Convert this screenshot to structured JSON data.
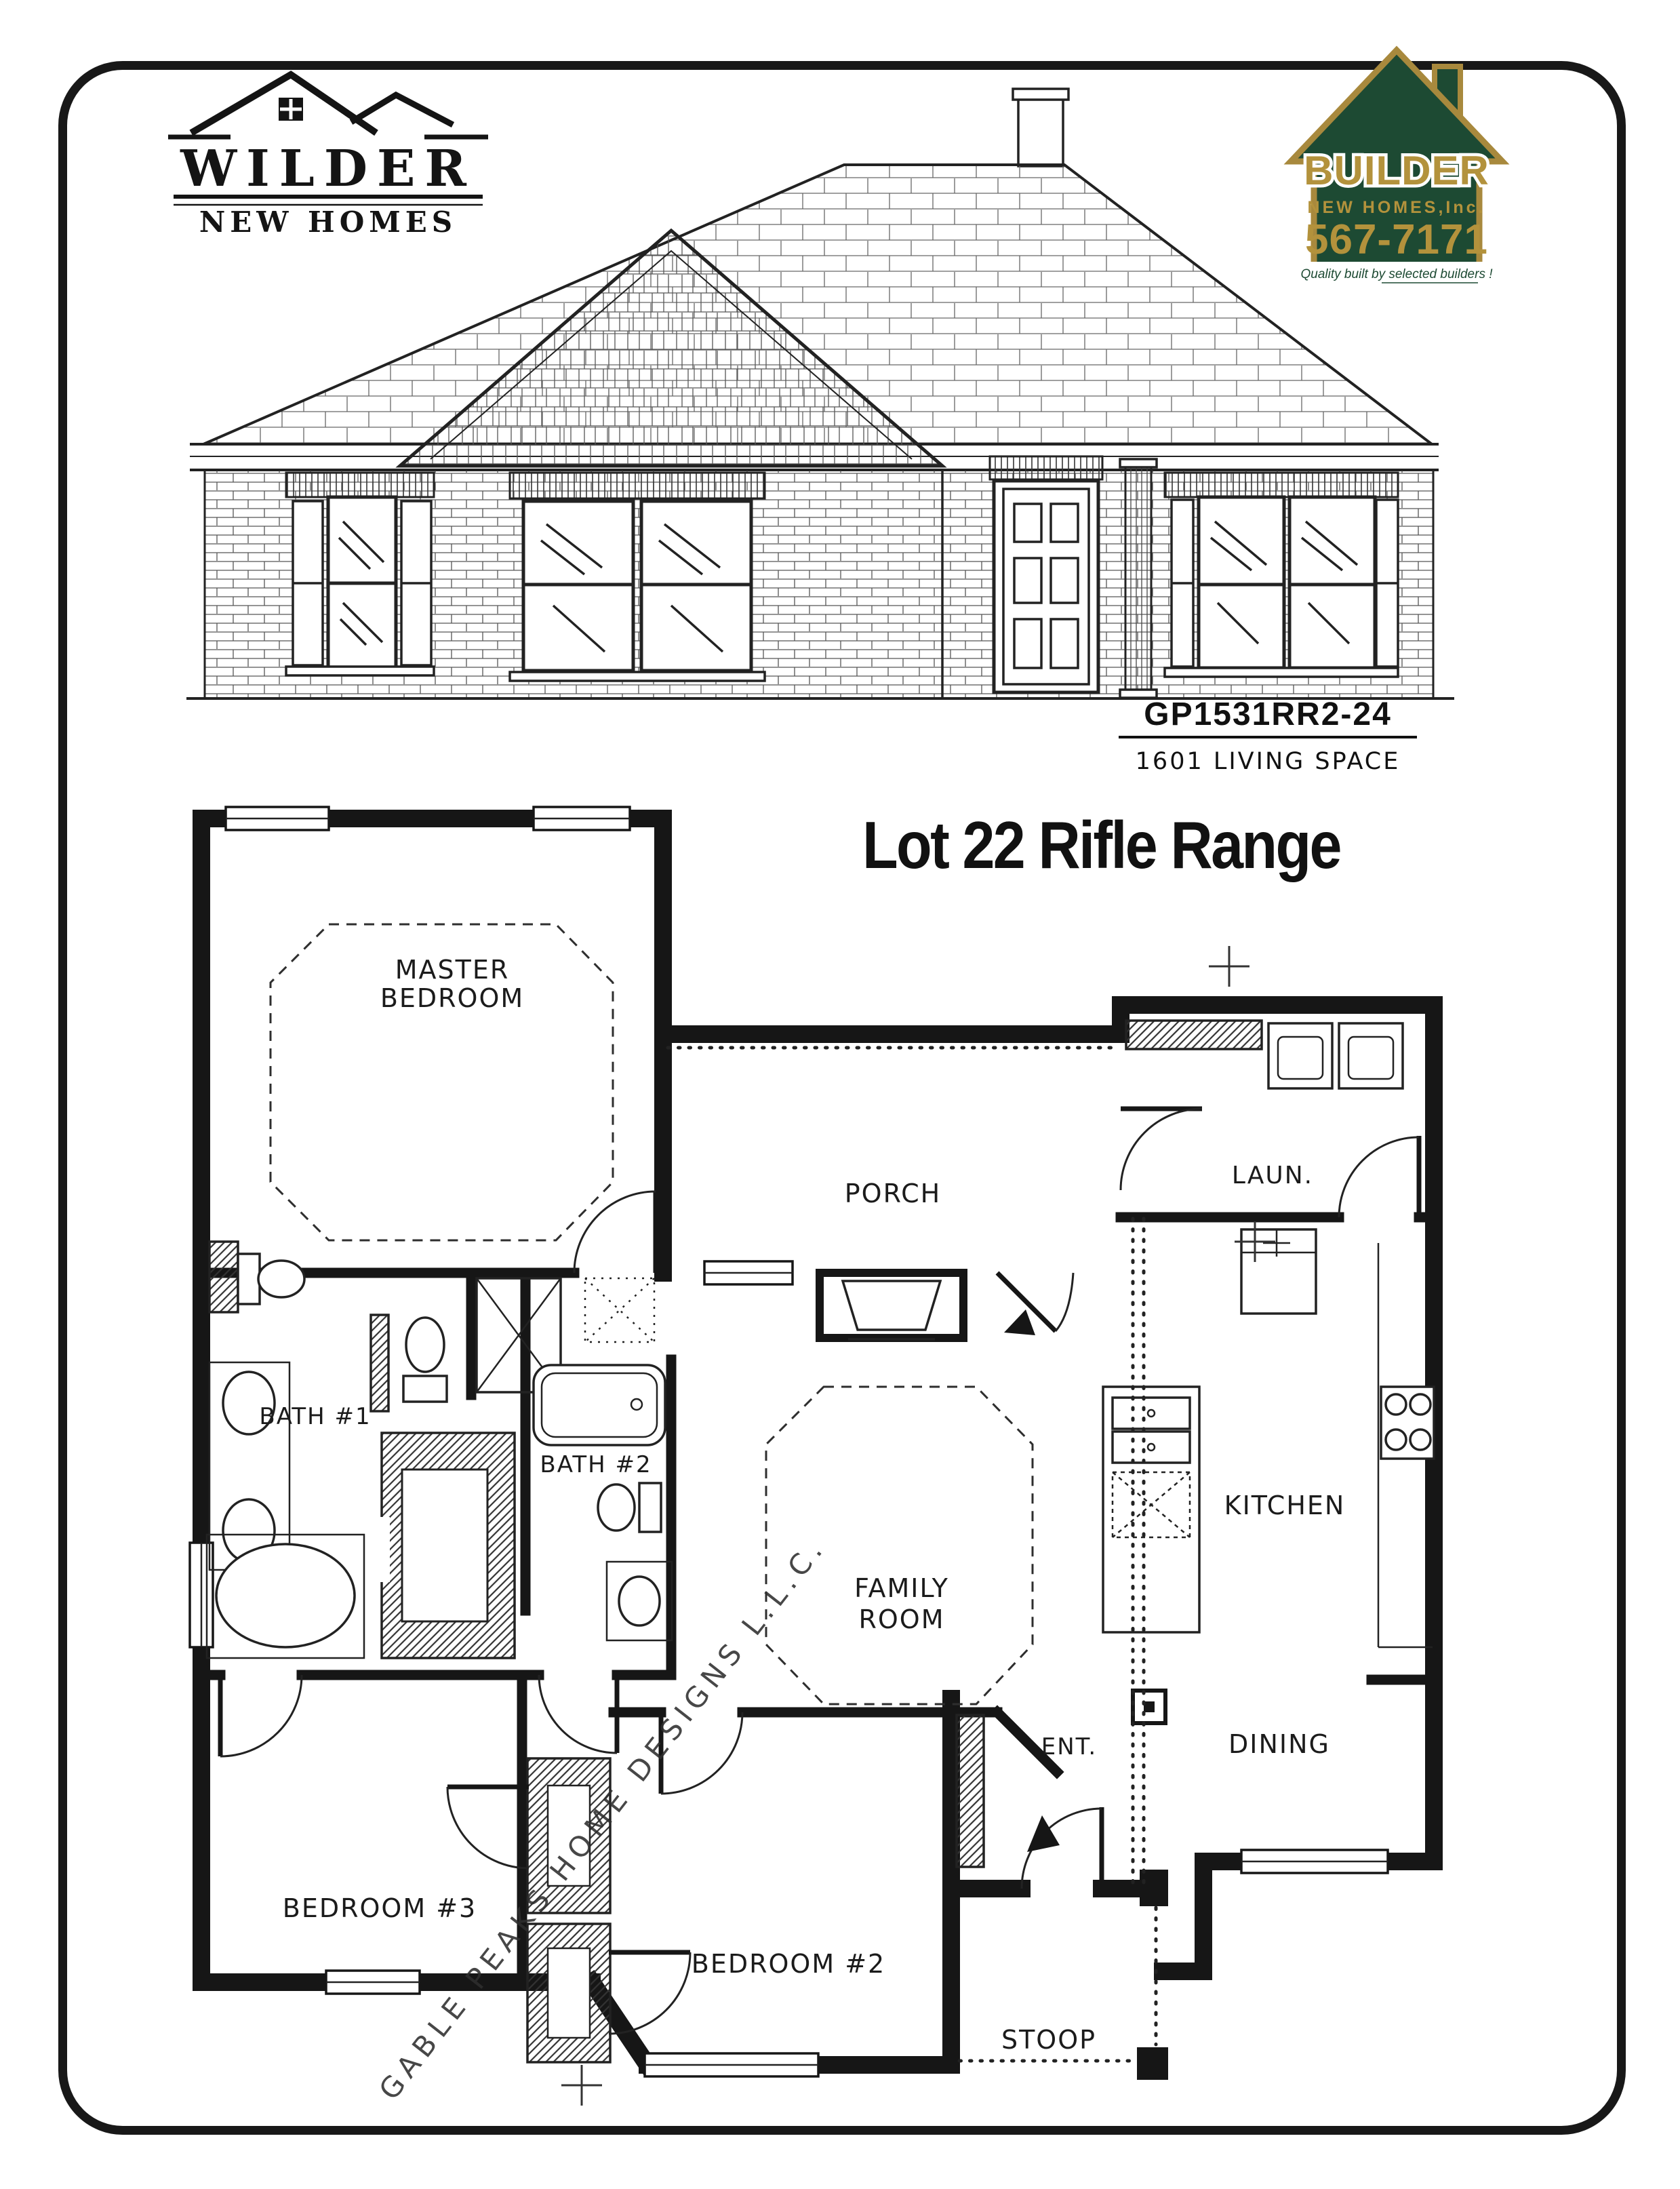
{
  "header": {
    "wilder_logo": {
      "line1": "WILDER",
      "line2": "NEW HOMES"
    },
    "builder_logo": {
      "line1": "BUILDER",
      "line2": "NEW HOMES,Inc.",
      "phone": "567-7171",
      "tagline": "Quality built by selected builders !",
      "green": "#1d4a33",
      "gold": "#a8893d"
    }
  },
  "plan_info": {
    "model_code": "GP1531RR2-24",
    "living_space": "1601 LIVING SPACE",
    "lot_title": "Lot 22 Rifle Range"
  },
  "floor_plan": {
    "watermark": "GABLE PEAKS HOME DESIGNS L.L.C.",
    "rooms": {
      "master1": "MASTER",
      "master2": "BEDROOM",
      "porch": "PORCH",
      "laundry": "LAUN.",
      "bath1": "BATH #1",
      "bath2": "BATH #2",
      "family1": "FAMILY",
      "family2": "ROOM",
      "kitchen": "KITCHEN",
      "dining": "DINING",
      "bed3": "BEDROOM #3",
      "bed2": "BEDROOM #2",
      "entry": "ENT.",
      "stoop": "STOOP"
    }
  }
}
